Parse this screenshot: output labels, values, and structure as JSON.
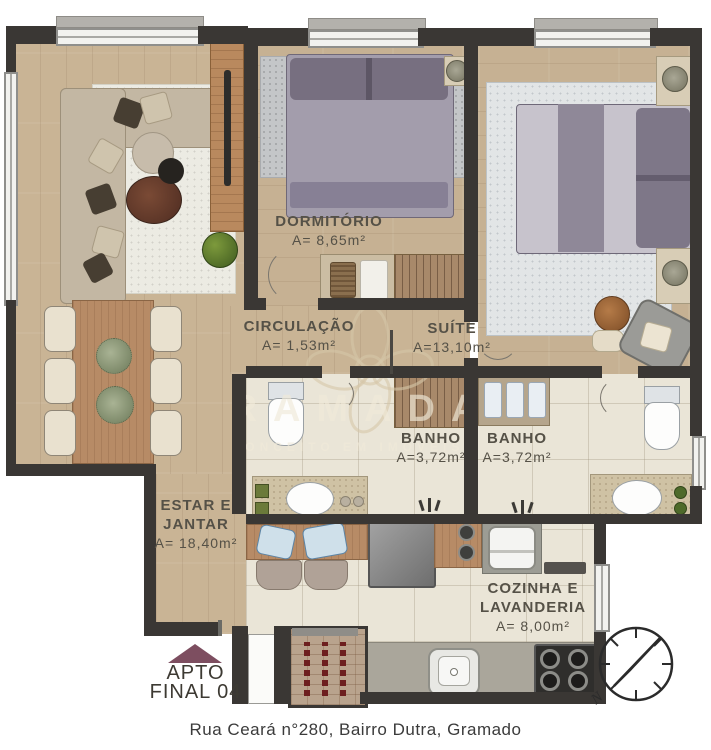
{
  "rooms": {
    "estar": {
      "line1": "ESTAR E",
      "line2": "JANTAR",
      "area": "A= 18,40m²"
    },
    "dormitorio": {
      "name": "DORMITÓRIO",
      "area": "A= 8,65m²"
    },
    "circulacao": {
      "name": "CIRCULAÇÃO",
      "area": "A= 1,53m²"
    },
    "suite": {
      "name": "SUÍTE",
      "area": "A=13,10m²"
    },
    "banho1": {
      "name": "BANHO",
      "area": "A=3,72m²"
    },
    "banho2": {
      "name": "BANHO",
      "area": "A=3,72m²"
    },
    "cozinha": {
      "line1": "COZINHA E",
      "line2": "LAVANDERIA",
      "area": "A= 8,00m²"
    }
  },
  "unit": {
    "line1": "APTO",
    "line2": "FINAL 04"
  },
  "address": "Rua Ceará n°280, Bairro Dutra, Gramado",
  "watermark": {
    "brand": "RAMADA",
    "tagline": "CONCEITO EM IMÓVEIS"
  },
  "compass": {
    "north_label": "N"
  },
  "colors": {
    "wall": "#3a3734",
    "wood_floor": "#c9b495",
    "tile_floor": "#eae5d7",
    "unit_arrow": "#7d4e60",
    "window_glass": "#f2f2ef",
    "watermark": "#d8cbb2",
    "label_text": "#555147"
  }
}
